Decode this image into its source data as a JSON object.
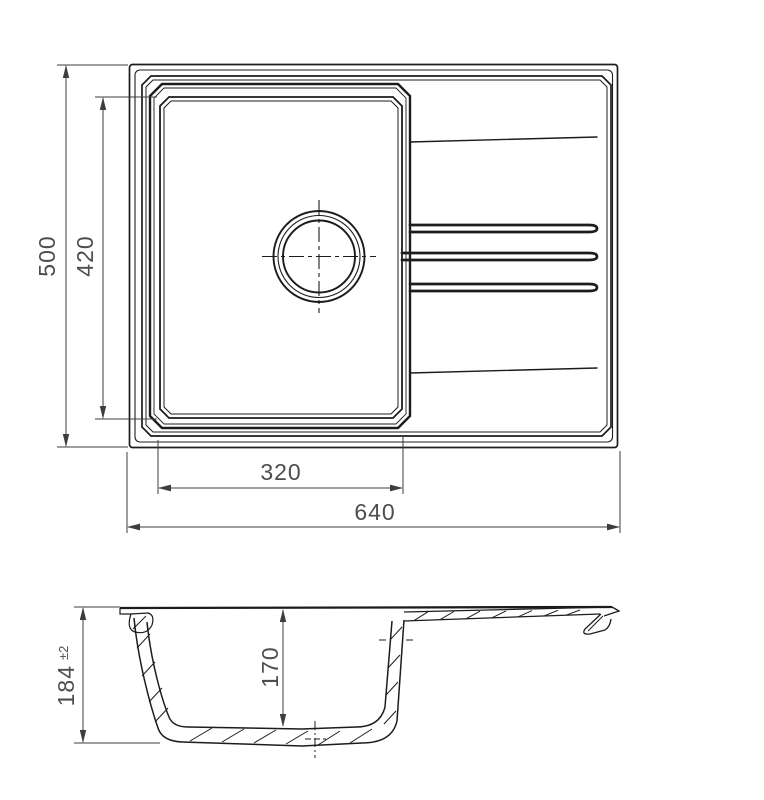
{
  "drawing": {
    "type": "sink technical drawing, top view and section view",
    "colors": {
      "line": "#1c1c1c",
      "dimension_line": "#3d3d3d",
      "dimension_text": "#4d4d4d",
      "background": "#ffffff"
    }
  },
  "dimensions": {
    "overall_depth": "500",
    "bowl_length": "420",
    "bowl_width": "320",
    "overall_width": "640",
    "height": "184",
    "height_tolerance": "±2",
    "bowl_depth": "170"
  }
}
